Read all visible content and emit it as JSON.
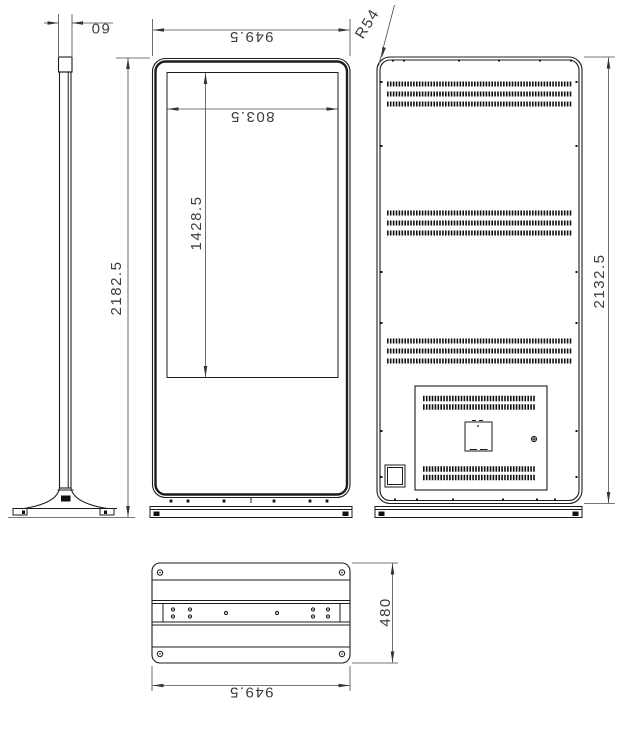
{
  "drawing": {
    "title": "kiosk-technical-drawing",
    "views": {
      "side": "side-view",
      "front": "front-view",
      "back": "back-view",
      "bottom": "base-plate-view"
    },
    "dims": {
      "side_thickness": "60",
      "overall_height": "2182.5",
      "cabinet_width": "949.5",
      "screen_width": "803.5",
      "screen_height": "1428.5",
      "corner_radius": "R54",
      "cabinet_height": "2132.5",
      "base_depth": "480",
      "base_width": "949.5"
    }
  }
}
